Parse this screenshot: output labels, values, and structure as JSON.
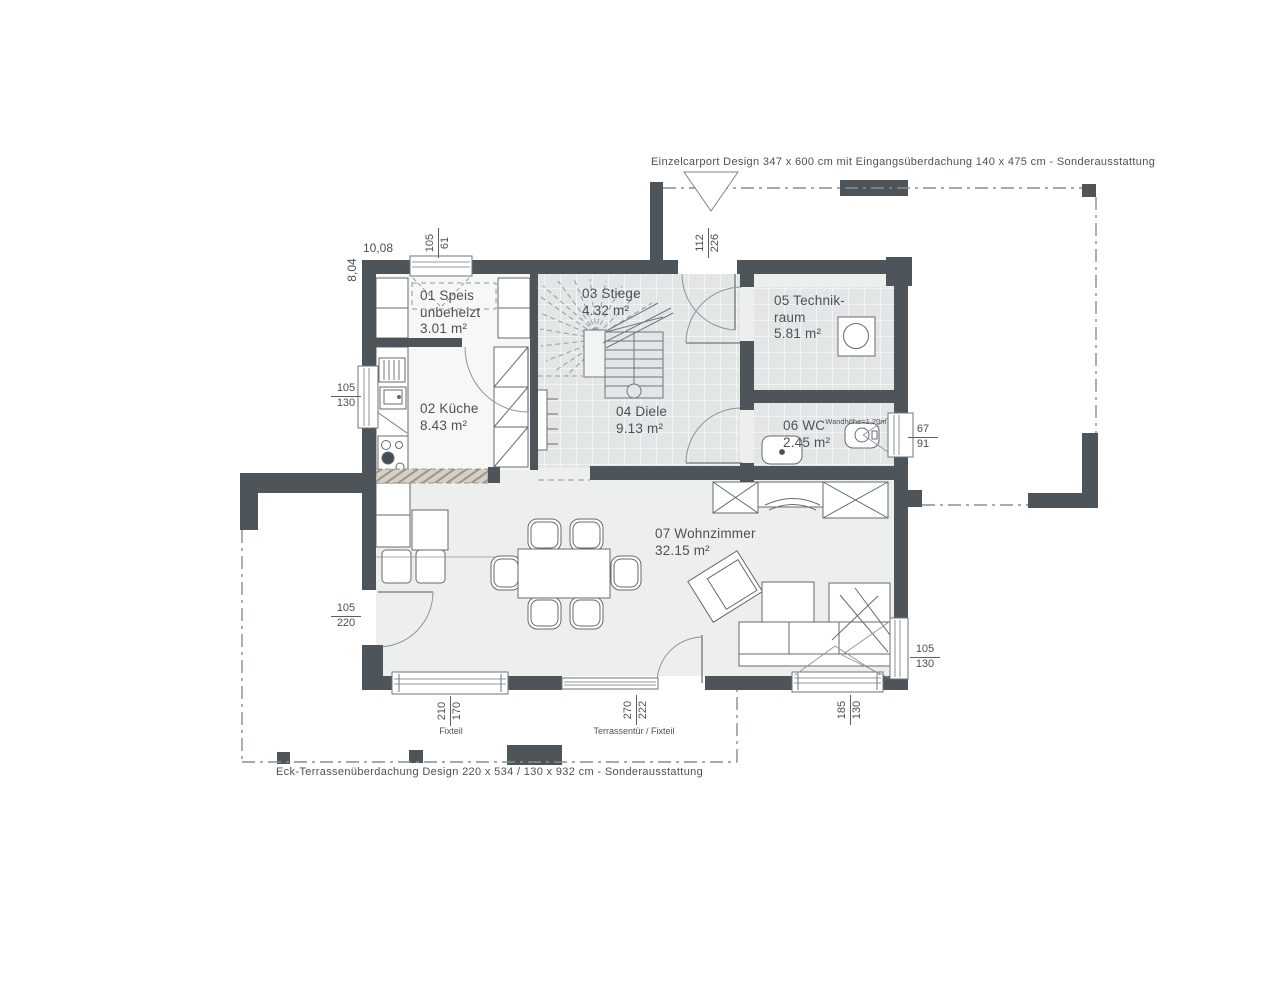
{
  "annotations": {
    "carport": "Einzelcarport Design 347 x 600 cm mit Eingangsüberdachung 140 x 475 cm  - Sonderausstattung",
    "terrace": "Eck-Terrassenüberdachung Design 220 x 534 / 130 x 932 cm - Sonderausstattung"
  },
  "overall_dims": {
    "width": "10,08",
    "height": "8,04"
  },
  "rooms": [
    {
      "lines": [
        "01 Speis",
        "unbeheizt",
        "3.01 m²"
      ]
    },
    {
      "lines": [
        "02 Küche",
        "8.43 m²"
      ]
    },
    {
      "lines": [
        "03 Stiege",
        "4.32 m²"
      ]
    },
    {
      "lines": [
        "04 Diele",
        "9.13 m²"
      ]
    },
    {
      "lines": [
        "05 Technik-",
        "raum",
        "5.81 m²"
      ]
    },
    {
      "lines": [
        "06 WC",
        "2.45 m²"
      ],
      "note": "Wandhöhe=1,20m"
    },
    {
      "lines": [
        "07 Wohnzimmer",
        "32.15 m²"
      ]
    }
  ],
  "dimensions": {
    "top_window": {
      "a": "105",
      "b": "61"
    },
    "entrance_door": {
      "a": "112",
      "b": "226"
    },
    "left_upper_window": {
      "a": "105",
      "b": "130"
    },
    "left_lower_door": {
      "a": "105",
      "b": "220"
    },
    "right_wc_window": {
      "a": "67",
      "b": "91"
    },
    "right_lower_window": {
      "a": "105",
      "b": "130"
    },
    "bottom_left_window": {
      "a": "210",
      "b": "170",
      "caption": "Fixteil"
    },
    "bottom_terrace_door": {
      "a": "270",
      "b": "222",
      "caption": "Terrassentür / Fixteil"
    },
    "bottom_right_window": {
      "a": "185",
      "b": "130"
    }
  },
  "colors": {
    "wall": "#4d555b",
    "tile": "#e3e6e6",
    "floor": "#edefef",
    "hatch": "#d6cfc4"
  }
}
